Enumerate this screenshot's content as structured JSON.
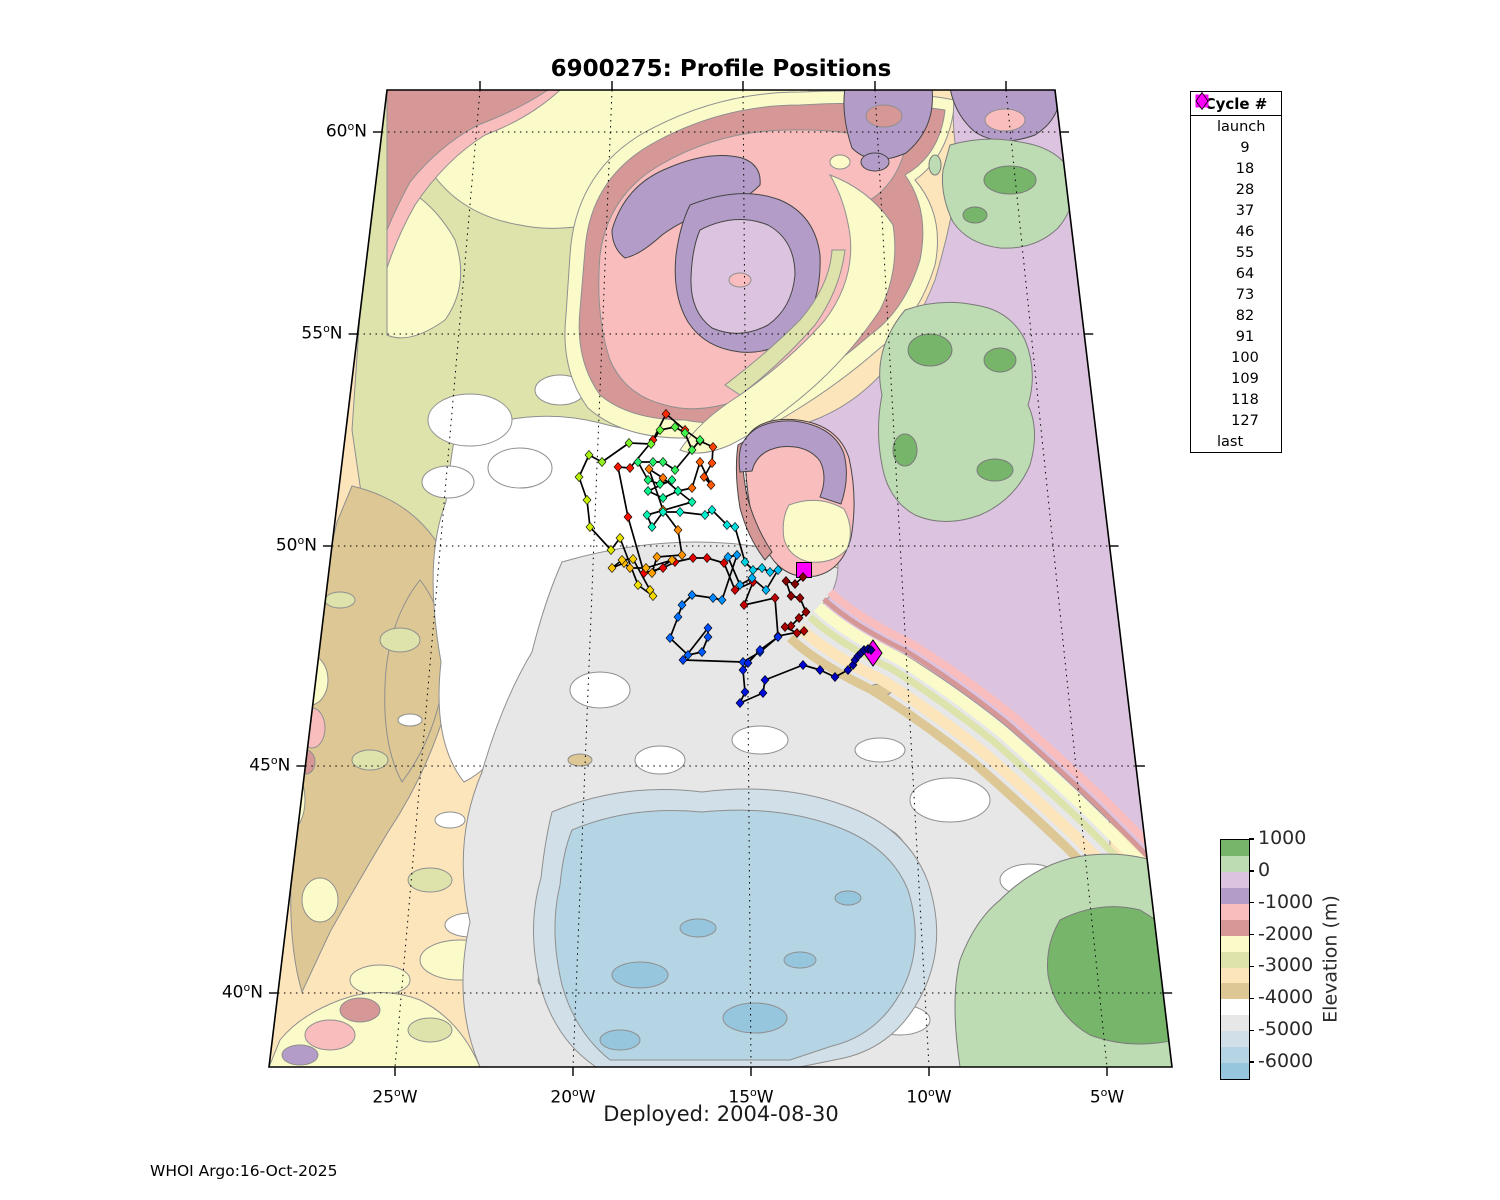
{
  "title": "6900275: Profile Positions",
  "subtitle": "Deployed: 2004-08-30",
  "credit": "WHOI Argo:16-Oct-2025",
  "legend": {
    "title": "Cycle #",
    "launch_label": "launch",
    "last_label": "last",
    "endpoint_marker_color": "#ff00ff",
    "cycles": [
      9,
      18,
      28,
      37,
      46,
      55,
      64,
      73,
      82,
      91,
      100,
      109,
      118,
      127
    ]
  },
  "colorbar": {
    "axis_label": "Elevation (m)",
    "tick_labels": [
      "1000",
      "0",
      "-1000",
      "-2000",
      "-3000",
      "-4000",
      "-5000",
      "-6000"
    ],
    "value_top": 1000,
    "value_bottom": -6500,
    "segment_step_m": 500
  },
  "elevation_palette": [
    "#77b56b",
    "#bedcb3",
    "#dcc3df",
    "#b49cc8",
    "#f9bdbd",
    "#d69896",
    "#fbfbc9",
    "#dee3ab",
    "#fce5bb",
    "#ddc794",
    "#ffffff",
    "#e7e7e7",
    "#d0dfe8",
    "#b5d4e4",
    "#96c6de"
  ],
  "colormap_stops": [
    [
      0.0,
      "#7f0000"
    ],
    [
      0.08,
      "#b40000"
    ],
    [
      0.16,
      "#f00000"
    ],
    [
      0.22,
      "#ff3800"
    ],
    [
      0.29,
      "#ff7d00"
    ],
    [
      0.36,
      "#ffb900"
    ],
    [
      0.41,
      "#f0e000"
    ],
    [
      0.44,
      "#c8f000"
    ],
    [
      0.5,
      "#46f046"
    ],
    [
      0.57,
      "#0ef07e"
    ],
    [
      0.64,
      "#00f0cd"
    ],
    [
      0.71,
      "#00bdf5"
    ],
    [
      0.78,
      "#0077ff"
    ],
    [
      0.85,
      "#0034f0"
    ],
    [
      0.92,
      "#0000d2"
    ],
    [
      1.0,
      "#000080"
    ]
  ],
  "axes": {
    "degree_symbol": "o",
    "lat_suffix": "N",
    "lon_suffix": "W",
    "lat_ticks": [
      {
        "label": "60",
        "y": 132
      },
      {
        "label": "55",
        "y": 334
      },
      {
        "label": "50",
        "y": 546
      },
      {
        "label": "45",
        "y": 766
      },
      {
        "label": "40",
        "y": 993
      }
    ],
    "lon_ticks": [
      {
        "label": "25",
        "x_top": 480,
        "x_bottom": 395
      },
      {
        "label": "20",
        "x_top": 612,
        "x_bottom": 573
      },
      {
        "label": "15",
        "x_top": 743,
        "x_bottom": 751
      },
      {
        "label": "10",
        "x_top": 875,
        "x_bottom": 929
      },
      {
        "label": "5",
        "x_top": 1006,
        "x_bottom": 1107
      }
    ]
  },
  "chart_data": {
    "type": "scatter",
    "title": "6900275: Profile Positions",
    "deployed": "2004-08-30",
    "float_id": "6900275",
    "legend_position": "upper right",
    "lat_tick_labels": [
      "60N",
      "55N",
      "50N",
      "45N",
      "40N"
    ],
    "lon_tick_labels": [
      "25W",
      "20W",
      "15W",
      "10W",
      "5W"
    ],
    "elevation_range_m": [
      -6500,
      1000
    ],
    "cycle_range": [
      1,
      127
    ],
    "launch": [
      804,
      570
    ],
    "last": [
      873,
      653
    ],
    "points": [
      [
        803,
        577
      ],
      [
        795,
        584
      ],
      [
        786,
        581
      ],
      [
        791,
        596
      ],
      [
        800,
        598
      ],
      [
        806,
        612
      ],
      [
        799,
        618
      ],
      [
        791,
        626
      ],
      [
        785,
        627
      ],
      [
        797,
        633
      ],
      [
        804,
        631
      ],
      [
        778,
        636
      ],
      [
        775,
        598
      ],
      [
        744,
        605
      ],
      [
        753,
        582
      ],
      [
        735,
        590
      ],
      [
        724,
        563
      ],
      [
        707,
        558
      ],
      [
        693,
        558
      ],
      [
        675,
        562
      ],
      [
        663,
        568
      ],
      [
        644,
        573
      ],
      [
        628,
        517
      ],
      [
        618,
        467
      ],
      [
        630,
        468
      ],
      [
        653,
        440
      ],
      [
        666,
        414
      ],
      [
        685,
        430
      ],
      [
        700,
        441
      ],
      [
        713,
        447
      ],
      [
        712,
        463
      ],
      [
        704,
        477
      ],
      [
        711,
        485
      ],
      [
        700,
        462
      ],
      [
        692,
        488
      ],
      [
        678,
        491
      ],
      [
        663,
        478
      ],
      [
        649,
        469
      ],
      [
        663,
        510
      ],
      [
        678,
        530
      ],
      [
        682,
        555
      ],
      [
        657,
        557
      ],
      [
        652,
        573
      ],
      [
        672,
        560
      ],
      [
        646,
        568
      ],
      [
        630,
        568
      ],
      [
        624,
        563
      ],
      [
        612,
        568
      ],
      [
        622,
        560
      ],
      [
        633,
        559
      ],
      [
        650,
        590
      ],
      [
        653,
        596
      ],
      [
        638,
        585
      ],
      [
        620,
        538
      ],
      [
        611,
        550
      ],
      [
        590,
        527
      ],
      [
        587,
        500
      ],
      [
        579,
        477
      ],
      [
        589,
        455
      ],
      [
        602,
        462
      ],
      [
        629,
        443
      ],
      [
        651,
        444
      ],
      [
        660,
        430
      ],
      [
        675,
        427
      ],
      [
        685,
        433
      ],
      [
        692,
        450
      ],
      [
        700,
        440
      ],
      [
        675,
        470
      ],
      [
        663,
        462
      ],
      [
        653,
        462
      ],
      [
        638,
        462
      ],
      [
        648,
        480
      ],
      [
        660,
        484
      ],
      [
        672,
        480
      ],
      [
        648,
        491
      ],
      [
        663,
        498
      ],
      [
        678,
        491
      ],
      [
        692,
        502
      ],
      [
        647,
        515
      ],
      [
        652,
        527
      ],
      [
        663,
        512
      ],
      [
        680,
        512
      ],
      [
        705,
        515
      ],
      [
        712,
        510
      ],
      [
        727,
        525
      ],
      [
        735,
        527
      ],
      [
        745,
        562
      ],
      [
        753,
        570
      ],
      [
        762,
        568
      ],
      [
        770,
        572
      ],
      [
        778,
        570
      ],
      [
        766,
        590
      ],
      [
        752,
        578
      ],
      [
        740,
        585
      ],
      [
        728,
        557
      ],
      [
        737,
        555
      ],
      [
        722,
        600
      ],
      [
        713,
        598
      ],
      [
        692,
        595
      ],
      [
        682,
        605
      ],
      [
        678,
        617
      ],
      [
        670,
        638
      ],
      [
        688,
        655
      ],
      [
        702,
        652
      ],
      [
        708,
        637
      ],
      [
        708,
        628
      ],
      [
        683,
        660
      ],
      [
        743,
        662
      ],
      [
        760,
        652
      ],
      [
        778,
        637
      ],
      [
        760,
        650
      ],
      [
        748,
        663
      ],
      [
        743,
        670
      ],
      [
        745,
        692
      ],
      [
        740,
        703
      ],
      [
        763,
        693
      ],
      [
        765,
        680
      ],
      [
        803,
        665
      ],
      [
        820,
        670
      ],
      [
        835,
        677
      ],
      [
        848,
        670
      ],
      [
        853,
        665
      ],
      [
        855,
        660
      ],
      [
        858,
        656
      ],
      [
        861,
        653
      ],
      [
        864,
        650
      ],
      [
        868,
        649
      ],
      [
        871,
        650
      ]
    ]
  }
}
